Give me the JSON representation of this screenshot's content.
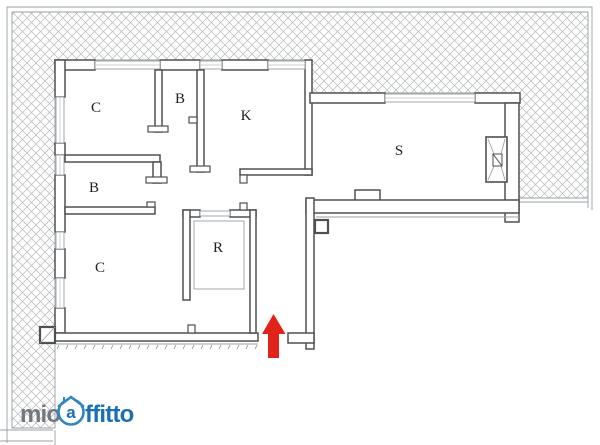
{
  "page": {
    "background": "#ffffff",
    "type": "apartment floor plan listing image"
  },
  "plan": {
    "room_labels": [
      {
        "id": "bedroom-top-left",
        "label": "C"
      },
      {
        "id": "bathroom-top",
        "label": "B"
      },
      {
        "id": "kitchen",
        "label": "K"
      },
      {
        "id": "bathroom-left",
        "label": "B"
      },
      {
        "id": "bedroom-bottom-left",
        "label": "C"
      },
      {
        "id": "storage-room",
        "label": "R"
      },
      {
        "id": "living-room",
        "label": "S"
      }
    ]
  },
  "colors": {
    "arrow_red": "#e2231a",
    "wall_dark": "#4e5052",
    "thin_line": "#9aa0a3",
    "hatch_line": "#b5b8ba",
    "label_ink": "#1f1f1f",
    "logo_gray": "#73787c",
    "logo_blue": "#1a6fb5",
    "logo_ring_blue": "#2e86c1"
  },
  "logo": {
    "part1": "mio",
    "icon_letter": "a",
    "part2": "ffitto"
  },
  "icons": {
    "entrance_arrow": "entrance-arrow-icon",
    "house": "house-icon",
    "shaft": "shaft-symbol-icon"
  }
}
